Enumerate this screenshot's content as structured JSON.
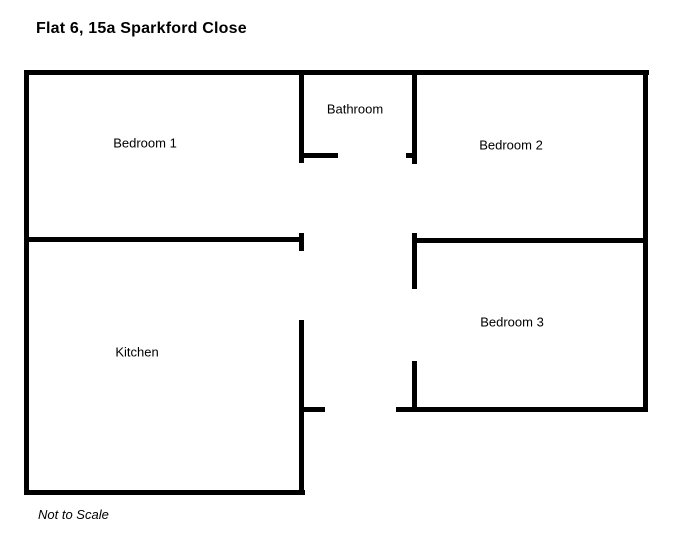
{
  "header": {
    "title": "Flat 6, 15a Sparkford Close"
  },
  "rooms": [
    {
      "label": "Bedroom 1"
    },
    {
      "label": "Bathroom"
    },
    {
      "label": "Bedroom 2"
    },
    {
      "label": "Kitchen"
    },
    {
      "label": "Bedroom 3"
    }
  ],
  "footer": {
    "note": "Not to Scale"
  },
  "colors": {
    "wall": "#000000",
    "text": "#000000",
    "background": "#ffffff"
  },
  "floorplan": {
    "walls": [
      {
        "name": "outer-top",
        "x": 24,
        "y": 70,
        "w": 625,
        "h": 5
      },
      {
        "name": "outer-left",
        "x": 24,
        "y": 70,
        "w": 5,
        "h": 425
      },
      {
        "name": "outer-right",
        "x": 643,
        "y": 70,
        "w": 5,
        "h": 342
      },
      {
        "name": "kitchen-bottom",
        "x": 24,
        "y": 490,
        "w": 281,
        "h": 5
      },
      {
        "name": "bedroom3-bottom",
        "x": 396,
        "y": 407,
        "w": 252,
        "h": 5
      },
      {
        "name": "bathroom-left",
        "x": 299,
        "y": 70,
        "w": 5,
        "h": 93
      },
      {
        "name": "bathroom-door-left",
        "x": 299,
        "y": 153,
        "w": 39,
        "h": 5
      },
      {
        "name": "bathroom-right",
        "x": 412,
        "y": 70,
        "w": 5,
        "h": 94
      },
      {
        "name": "bathroom-door-nub",
        "x": 406,
        "y": 153,
        "w": 6,
        "h": 5
      },
      {
        "name": "divider-left",
        "x": 24,
        "y": 237,
        "w": 280,
        "h": 5
      },
      {
        "name": "divider-left-endcap",
        "x": 299,
        "y": 233,
        "w": 5,
        "h": 18
      },
      {
        "name": "bedroom2-bottom",
        "x": 412,
        "y": 238,
        "w": 236,
        "h": 5
      },
      {
        "name": "bedroom3-left-upper",
        "x": 412,
        "y": 233,
        "w": 5,
        "h": 56
      },
      {
        "name": "bedroom3-left-lower",
        "x": 412,
        "y": 361,
        "w": 5,
        "h": 51
      },
      {
        "name": "kitchen-right",
        "x": 299,
        "y": 320,
        "w": 5,
        "h": 175
      },
      {
        "name": "hall-bottom-left-tick",
        "x": 299,
        "y": 407,
        "w": 26,
        "h": 5
      }
    ]
  }
}
